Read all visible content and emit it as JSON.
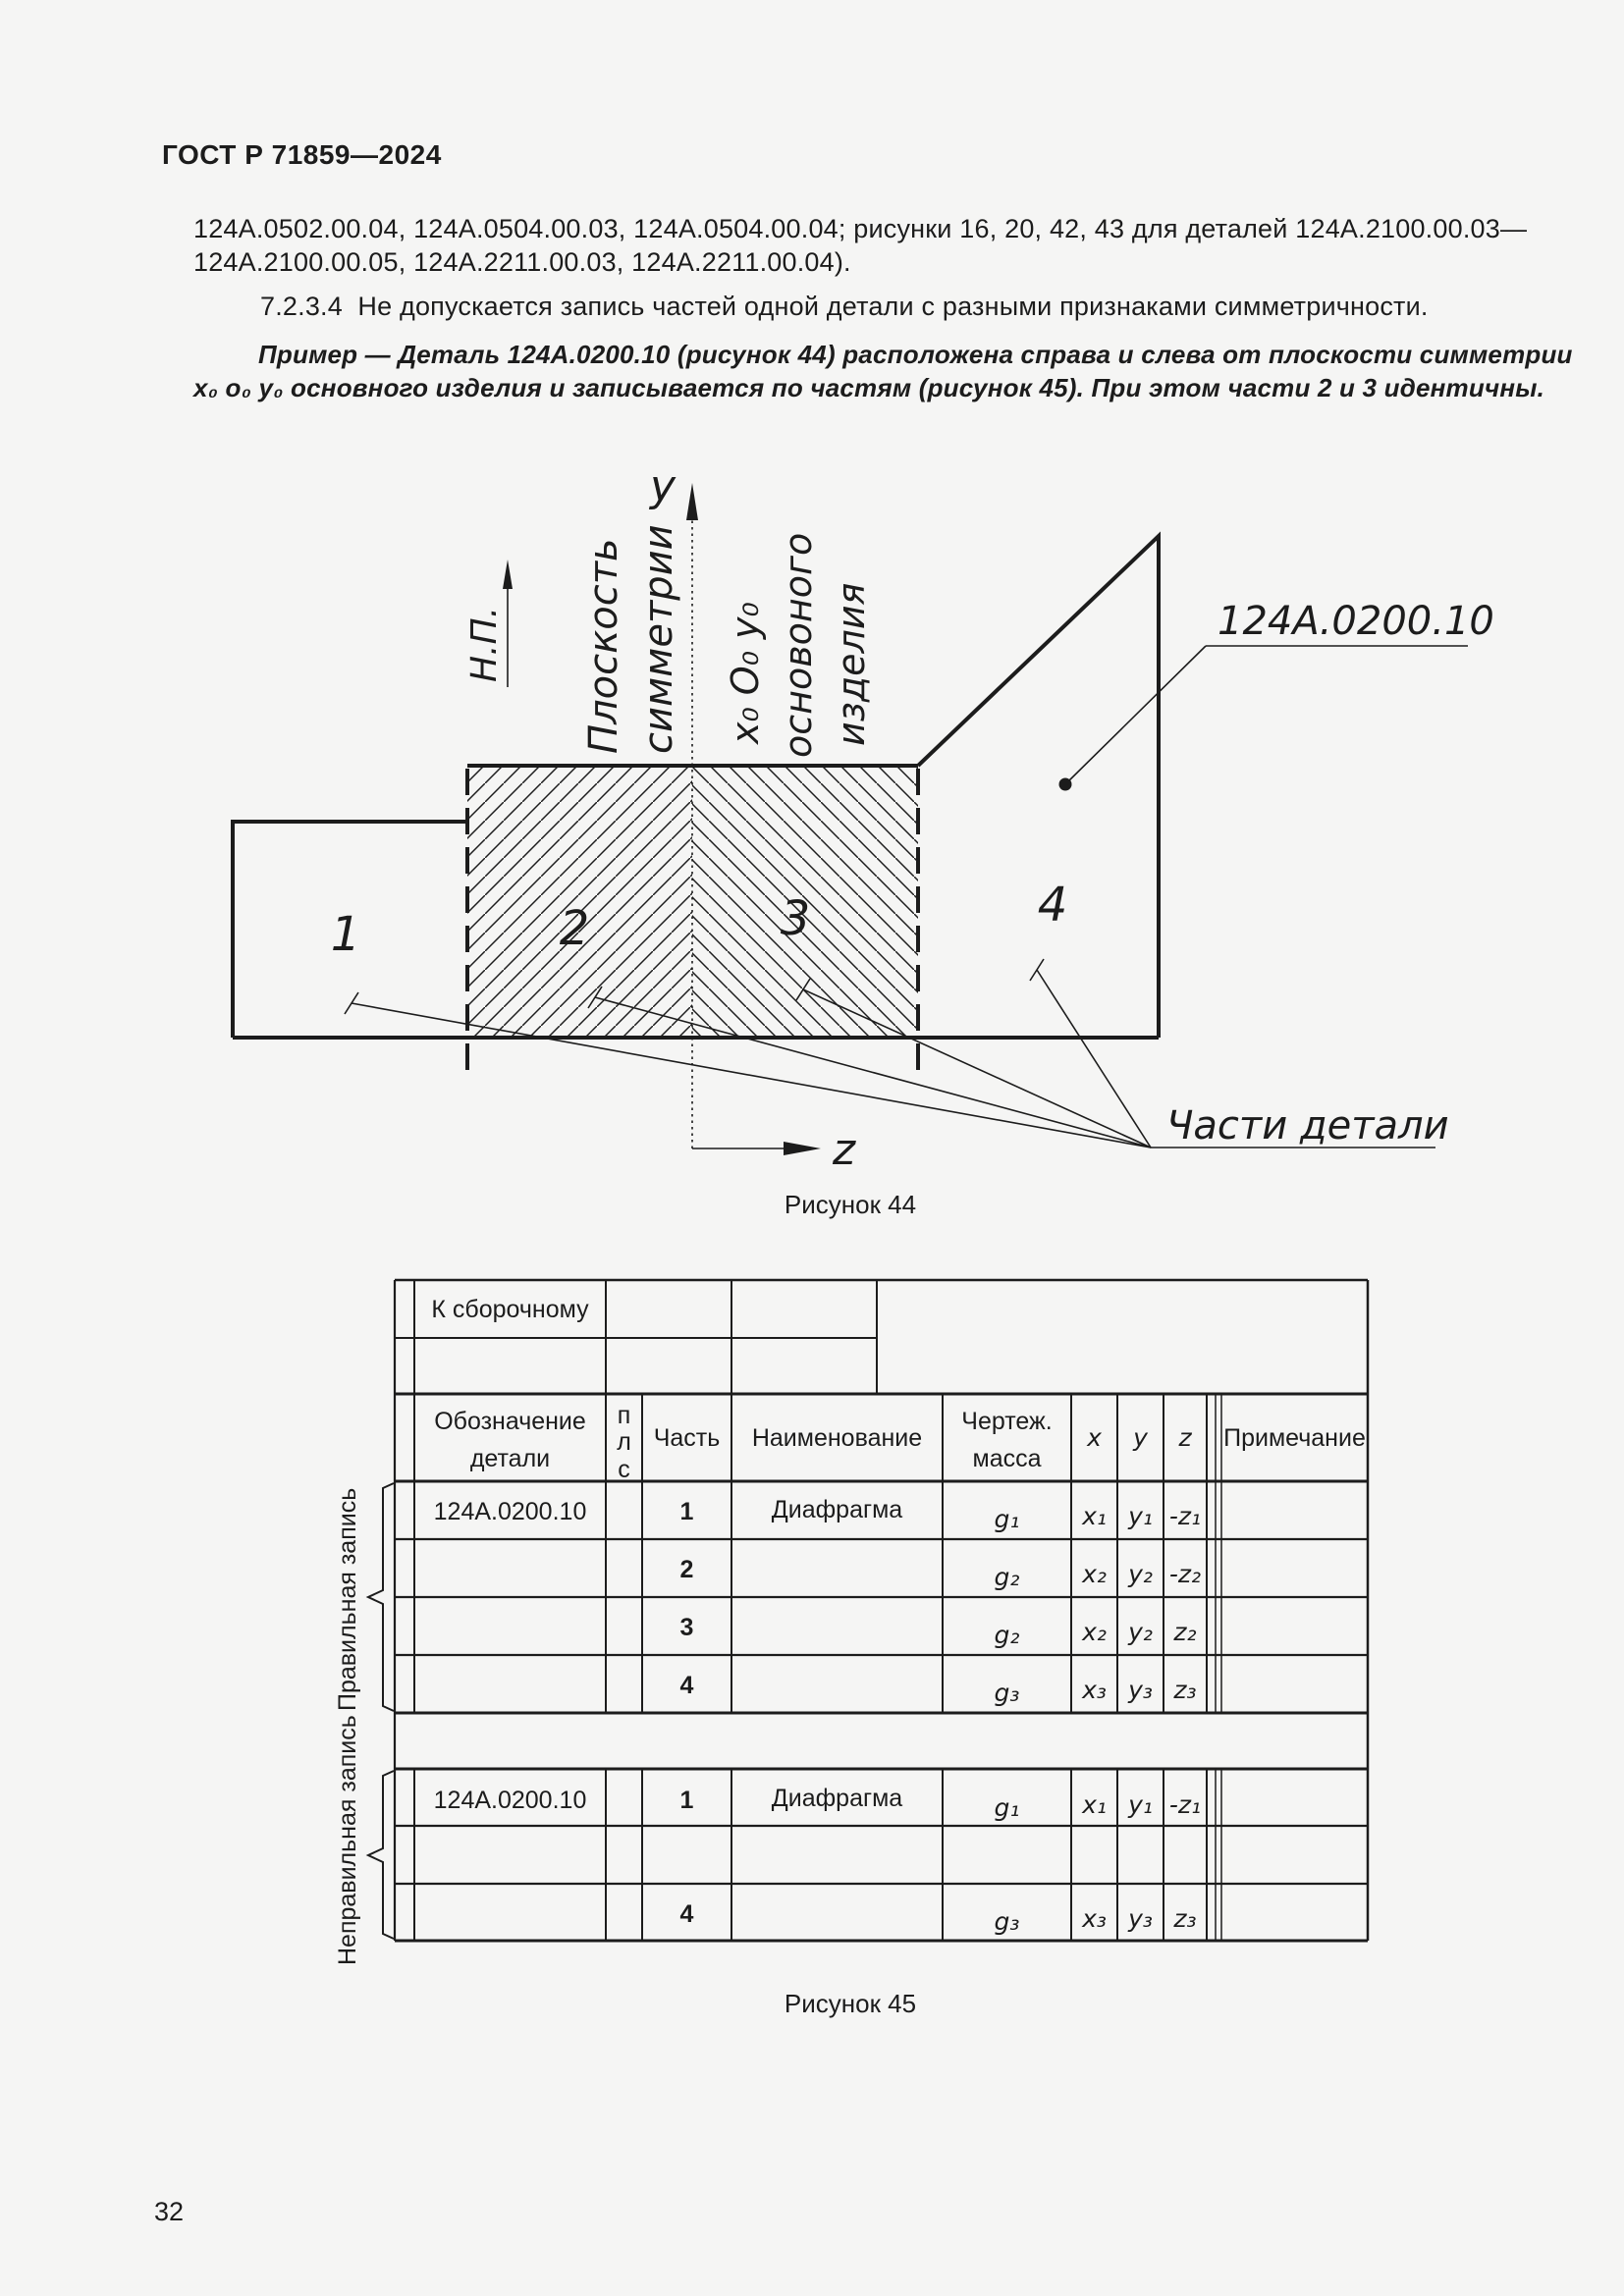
{
  "page": {
    "header": "ГОСТ Р 71859—2024",
    "page_number": "32",
    "background": "#f5f5f4",
    "ink": "#1c1c1c"
  },
  "paragraphs": {
    "p1_line1": "124А.0502.00.04, 124А.0504.00.03, 124А.0504.00.04; рисунки 16, 20, 42, 43 для деталей 124А.2100.00.03—",
    "p1_line2": "124А.2100.00.05, 124А.2211.00.03, 124А.2211.00.04).",
    "p2": "7.2.3.4  Не допускается запись частей одной детали с разными признаками симметричности.",
    "example_line1": "Пример — Деталь 124А.0200.10 (рисунок 44) расположена справа и слева от плоскости симметрии",
    "example_line2": "x₀ o₀ y₀ основного изделия и записывается по частям (рисунок 45). При этом части 2 и 3 идентичны."
  },
  "figure44": {
    "caption": "Рисунок 44",
    "axis_y": "y",
    "axis_z": "z",
    "np_label": "Н.П.",
    "sym_line1": "Плоскость",
    "sym_line2": "симметрии",
    "origin_line1": "x₀ O₀ y₀",
    "origin_line2": "основоного",
    "origin_line3": "изделия",
    "part_designation": "124А.0200.10",
    "parts_label": "Части детали",
    "part1": "1",
    "part2": "2",
    "part3": "3",
    "part4": "4"
  },
  "figure45": {
    "caption": "Рисунок 45",
    "top_label": "К сборочному",
    "headers": {
      "designation_l1": "Обозначение",
      "designation_l2": "детали",
      "pls": [
        "п",
        "л",
        "с"
      ],
      "part": "Часть",
      "name": "Наименование",
      "mass_l1": "Чертеж.",
      "mass_l2": "масса",
      "x": "x",
      "y": "y",
      "z": "z",
      "note": "Примечание"
    },
    "group1": {
      "label": "Правильная запись",
      "rows": [
        {
          "designation": "124А.0200.10",
          "part": "1",
          "name": "Диафрагма",
          "mass": "g₁",
          "x": "x₁",
          "y": "y₁",
          "z": "-z₁",
          "note": ""
        },
        {
          "designation": "",
          "part": "2",
          "name": "",
          "mass": "g₂",
          "x": "x₂",
          "y": "y₂",
          "z": "-z₂",
          "note": ""
        },
        {
          "designation": "",
          "part": "3",
          "name": "",
          "mass": "g₂",
          "x": "x₂",
          "y": "y₂",
          "z": "z₂",
          "note": ""
        },
        {
          "designation": "",
          "part": "4",
          "name": "",
          "mass": "g₃",
          "x": "x₃",
          "y": "y₃",
          "z": "z₃",
          "note": ""
        }
      ]
    },
    "group2": {
      "label": "Неправильная запись",
      "rows": [
        {
          "designation": "124А.0200.10",
          "part": "1",
          "name": "Диафрагма",
          "mass": "g₁",
          "x": "x₁",
          "y": "y₁",
          "z": "-z₁",
          "note": ""
        },
        {
          "designation": "",
          "part": "",
          "name": "",
          "mass": "",
          "x": "",
          "y": "",
          "z": "",
          "note": ""
        },
        {
          "designation": "",
          "part": "4",
          "name": "",
          "mass": "g₃",
          "x": "x₃",
          "y": "y₃",
          "z": "z₃",
          "note": ""
        }
      ]
    }
  }
}
